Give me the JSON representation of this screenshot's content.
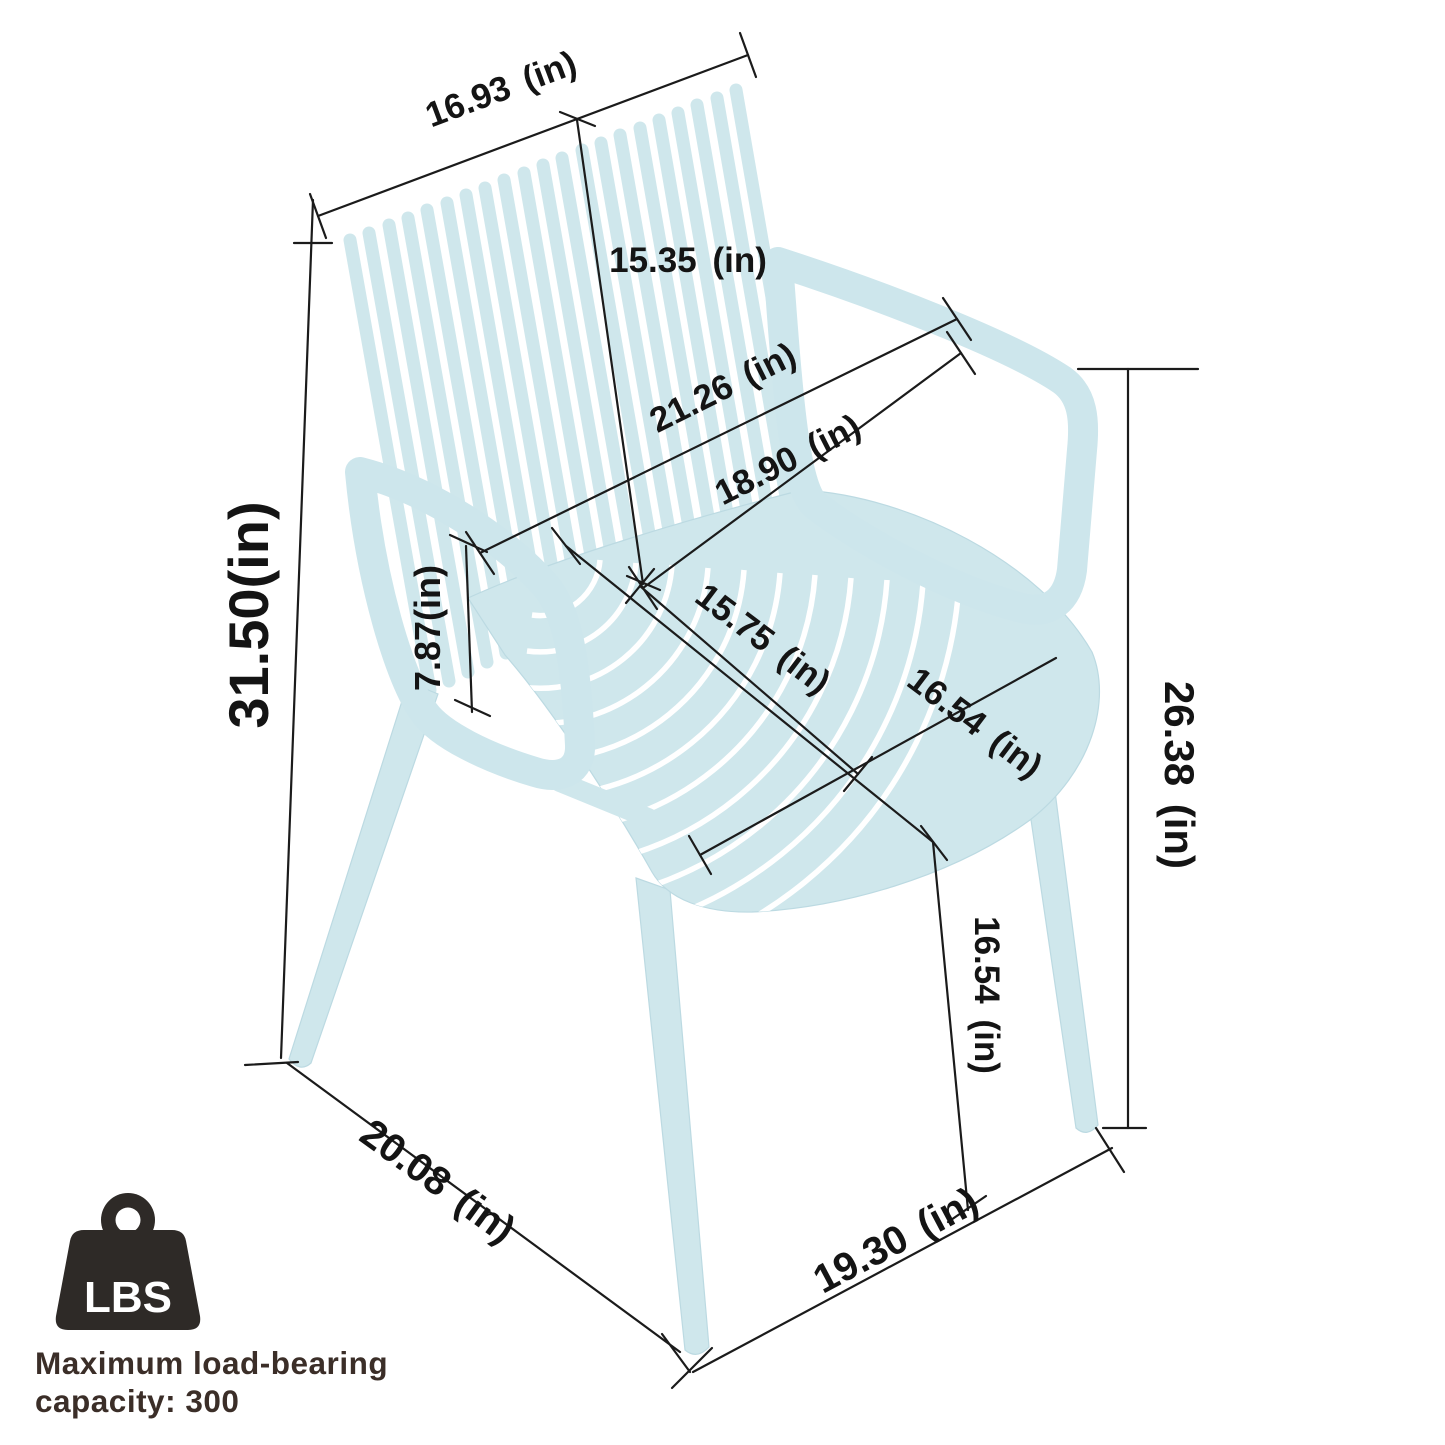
{
  "figure": {
    "type": "product-dimension-diagram",
    "subject": "stackable plastic armchair with slatted back and seat",
    "chair_color": "#cfe7ec",
    "dimension_line_color": "#1b1b1b",
    "badge_color": "#2e2a27",
    "caption_color": "#3b2e28"
  },
  "dimensions": [
    {
      "id": "back-top-width",
      "label": "16.93 (in)"
    },
    {
      "id": "backrest-height",
      "label": "15.35 (in)"
    },
    {
      "id": "overall-width",
      "label": "21.26 (in)"
    },
    {
      "id": "seat-back-width",
      "label": "18.90 (in)"
    },
    {
      "id": "overall-height",
      "label": "31.50(in)"
    },
    {
      "id": "armrest-height",
      "label": "7.87(in)"
    },
    {
      "id": "seat-depth",
      "label": "15.75 (in)"
    },
    {
      "id": "seat-width",
      "label": "16.54 (in)"
    },
    {
      "id": "armrest-to-floor",
      "label": "26.38 (in)"
    },
    {
      "id": "seat-height",
      "label": "16.54 (in)"
    },
    {
      "id": "base-depth",
      "label": "20.08 (in)"
    },
    {
      "id": "base-width",
      "label": "19.30 (in)"
    }
  ],
  "load_badge": {
    "icon_label": "LBS",
    "caption_line1": "Maximum load-bearing",
    "caption_line2": "capacity: 300"
  }
}
